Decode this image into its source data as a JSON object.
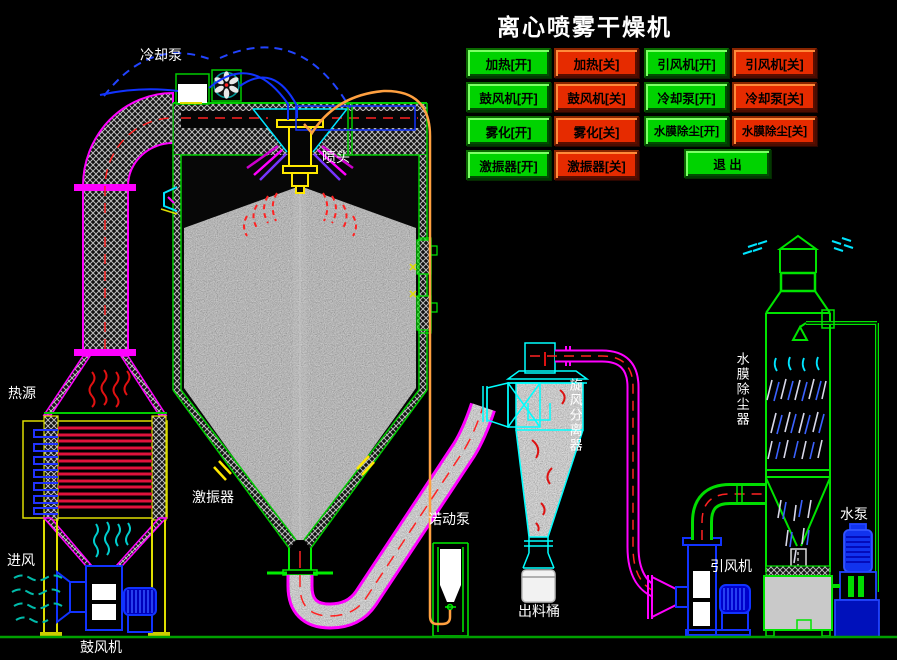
{
  "title": "离心喷雾干燥机",
  "control_panel": {
    "buttons": [
      {
        "label": "加热[开]",
        "state": "on"
      },
      {
        "label": "加热[关]",
        "state": "off"
      },
      {
        "label": "引风机[开]",
        "state": "on"
      },
      {
        "label": "引风机[关]",
        "state": "off"
      },
      {
        "label": "鼓风机[开]",
        "state": "on"
      },
      {
        "label": "鼓风机[关]",
        "state": "off"
      },
      {
        "label": "冷却泵[开]",
        "state": "on"
      },
      {
        "label": "冷却泵[关]",
        "state": "off"
      },
      {
        "label": "雾化[开]",
        "state": "on"
      },
      {
        "label": "雾化[关]",
        "state": "off"
      },
      {
        "label": "水膜除尘[开]",
        "state": "on"
      },
      {
        "label": "水膜除尘[关]",
        "state": "off"
      },
      {
        "label": "激振器[开]",
        "state": "on"
      },
      {
        "label": "激振器[关]",
        "state": "off"
      }
    ],
    "exit_label": "退 出"
  },
  "labels": {
    "cooling_pump": "冷却泵",
    "spray_head": "喷头",
    "heat_source": "热源",
    "air_inlet": "进风",
    "blower": "鼓风机",
    "vibrator": "激振器",
    "feed_pump": "诺动泵",
    "discharge_barrel": "出料桶",
    "cyclone_separator": "旋风分离器",
    "induced_draft_fan": "引风机",
    "water_film_dust_collector": "水膜除尘器",
    "water_pump": "水泵"
  },
  "colors": {
    "background": "#000000",
    "on_button": "#00d300",
    "off_button": "#e62b00",
    "pipe_magenta": "#ff00ff",
    "pipe_green": "#00dd00",
    "pipe_cyan": "#00ffff",
    "pipe_blue": "#1133ff",
    "feed_pipe_orange": "#ffa040",
    "flow_dash_red": "#ff2222",
    "heater_red": "#e1123c",
    "ground_green": "#00a000"
  }
}
